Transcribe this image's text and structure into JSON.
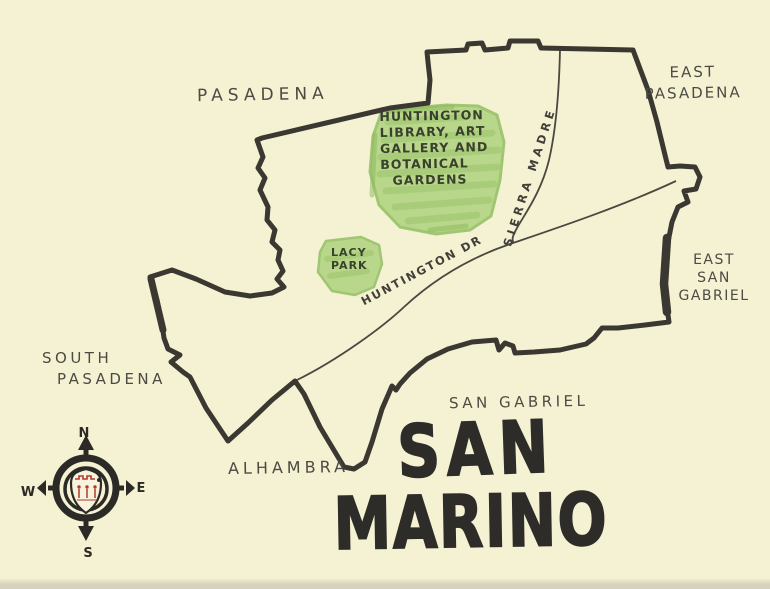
{
  "canvas": {
    "background_color": "#f5f1d3",
    "ink_color": "#3a3831",
    "park_green_color": "#b6d687",
    "crest_red_color": "#b23a2e"
  },
  "title": {
    "line1": "SAN",
    "line2": "MARINO"
  },
  "neighbors": {
    "pasadena": "PASADENA",
    "east_pasadena": {
      "lines": [
        "EAST",
        "PASADENA"
      ]
    },
    "east_san_gabriel": {
      "lines": [
        "EAST",
        "SAN",
        "GABRIEL"
      ]
    },
    "south_pasadena": {
      "lines": [
        "SOUTH",
        "PASADENA"
      ]
    },
    "alhambra": "ALHAMBRA",
    "san_gabriel": "SAN GABRIEL"
  },
  "parks": {
    "huntington": {
      "lines": [
        "HUNTINGTON",
        "LIBRARY, ART",
        "GALLERY AND",
        "BOTANICAL",
        "GARDENS"
      ]
    },
    "lacy": {
      "lines": [
        "LACY",
        "PARK"
      ]
    }
  },
  "roads": {
    "huntington_dr": "HUNTINGTON DR",
    "sierra_madre": "SIERRA MADRE"
  },
  "compass": {
    "north": "N",
    "east": "E",
    "west": "W",
    "south": "S"
  }
}
